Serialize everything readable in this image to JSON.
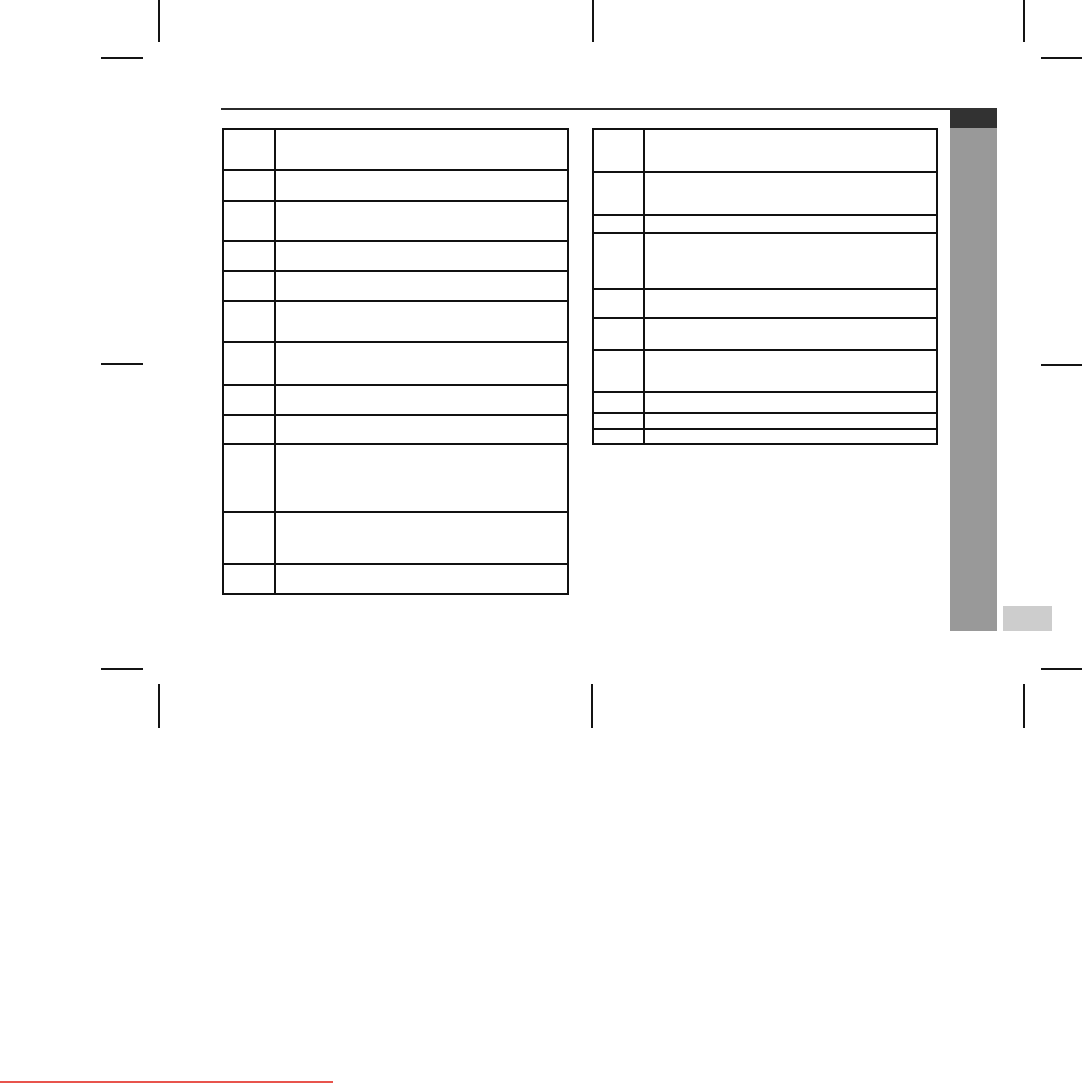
{
  "page": {
    "background": "#ffffff",
    "border_color": "#111111"
  },
  "header": {
    "rule_color": "#2b2b2b"
  },
  "side_tab": {
    "header_color": "#323232",
    "bar_color": "#999999",
    "footer_box_color": "#cdcdcd"
  },
  "artifacts": {
    "bottom_line_color": "#e8544c"
  },
  "tables": {
    "left": {
      "rows": [
        {
          "num": "",
          "description": "",
          "height": 39
        },
        {
          "num": "",
          "description": "",
          "height": 31
        },
        {
          "num": "",
          "description": "",
          "height": 40
        },
        {
          "num": "",
          "description": "",
          "height": 30
        },
        {
          "num": "",
          "description": "",
          "height": 30
        },
        {
          "num": "",
          "description": "",
          "height": 41
        },
        {
          "num": "",
          "description": "",
          "height": 43
        },
        {
          "num": "",
          "description": "",
          "height": 30
        },
        {
          "num": "",
          "description": "",
          "height": 29
        },
        {
          "num": "",
          "description": "",
          "height": 68
        },
        {
          "num": "",
          "description": "",
          "height": 52
        },
        {
          "num": "",
          "description": "",
          "height": 30
        }
      ]
    },
    "right": {
      "rows": [
        {
          "num": "",
          "description": "",
          "height": 41
        },
        {
          "num": "",
          "description": "",
          "height": 43
        },
        {
          "num": "",
          "description": "",
          "height": 18
        },
        {
          "num": "",
          "description": "",
          "height": 56
        },
        {
          "num": "",
          "description": "",
          "height": 29
        },
        {
          "num": "",
          "description": "",
          "height": 32
        },
        {
          "num": "",
          "description": "",
          "height": 42
        },
        {
          "num": "",
          "description": "",
          "height": 21
        },
        {
          "num": "",
          "description": "",
          "height": 16
        },
        {
          "num": "",
          "description": "",
          "height": 15
        }
      ]
    }
  }
}
